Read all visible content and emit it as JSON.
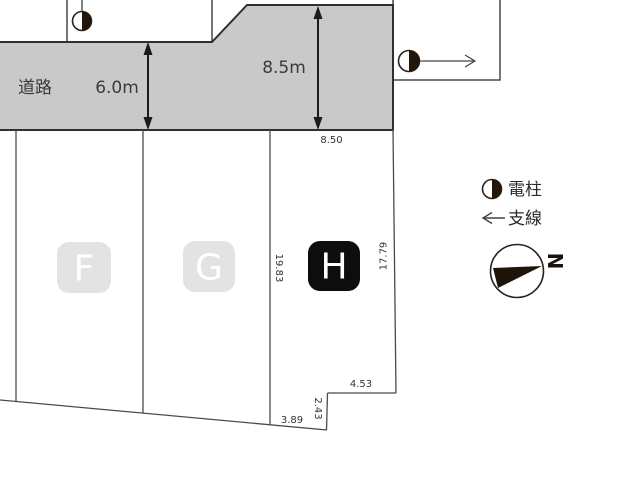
{
  "road": {
    "name_label": "道路",
    "width_dim": "6.0m",
    "depth_dim": "8.5m"
  },
  "plots": [
    {
      "label": "F"
    },
    {
      "label": "G"
    },
    {
      "label": "H"
    }
  ],
  "dimensions": {
    "road_frontage": "8.50",
    "h_west": "19.83",
    "h_east": "17.79",
    "h_step_depth": "2.43",
    "h_south_west": "3.89",
    "h_south_east": "4.53"
  },
  "legend": {
    "pole_label": "電柱",
    "wire_label": "支線",
    "north_label": "N"
  },
  "colors": {
    "road_fill": "#c9c9c9",
    "road_outline": "#2f2f2f",
    "plot_line": "#4a4a4a",
    "plot_badge_light": "#e3e3e3",
    "plot_badge_dark": "#0d0d0d",
    "badge_text": "#ffffff",
    "ink": "#1e1409"
  }
}
